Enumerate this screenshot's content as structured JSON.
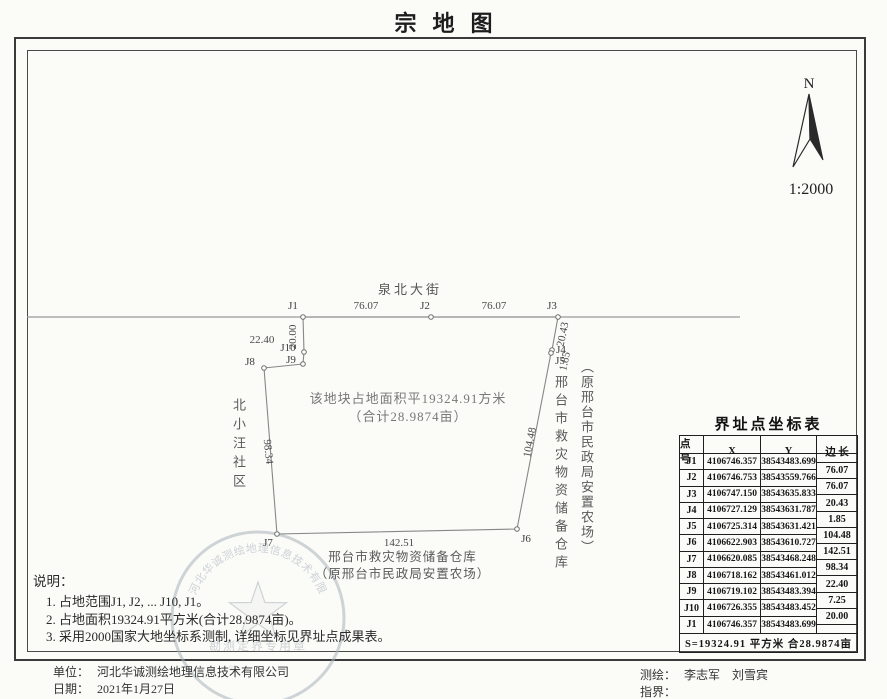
{
  "title": "宗地图",
  "north_arrow": {
    "n_label": "N",
    "scale": "1:2000"
  },
  "map": {
    "street_name": "泉北大街",
    "area_text_line1": "该地块占地面积平19324.91方米",
    "area_text_line2": "（合计28.9874亩）",
    "west_label": "北小汪社区",
    "east_label_1": "邢台市救灾物资储备仓库",
    "east_label_2": "（原邢台市民政局安置农场）",
    "south_label_1": "邢台市救灾物资储备仓库",
    "south_label_2": "（原邢台市民政局安置农场）",
    "street_line": {
      "x1": 27,
      "y1": 317,
      "x2": 740,
      "y2": 317
    },
    "points": [
      {
        "id": "J1",
        "px": 303,
        "py": 317,
        "lx": 293,
        "ly": 309
      },
      {
        "id": "J2",
        "px": 431,
        "py": 317,
        "lx": 425,
        "ly": 309
      },
      {
        "id": "J3",
        "px": 558,
        "py": 317,
        "lx": 552,
        "ly": 309
      },
      {
        "id": "J4",
        "px": 552,
        "py": 350,
        "lx": 561,
        "ly": 353
      },
      {
        "id": "J5",
        "px": 551,
        "py": 353,
        "lx": 560,
        "ly": 364
      },
      {
        "id": "J6",
        "px": 517,
        "py": 529,
        "lx": 526,
        "ly": 542
      },
      {
        "id": "J7",
        "px": 277,
        "py": 534,
        "lx": 268,
        "ly": 546
      },
      {
        "id": "J8",
        "px": 264,
        "py": 368,
        "lx": 250,
        "ly": 365
      },
      {
        "id": "J9",
        "px": 303,
        "py": 364,
        "lx": 291,
        "ly": 363
      },
      {
        "id": "J10",
        "px": 304,
        "py": 352,
        "lx": 288,
        "ly": 351
      }
    ],
    "edge_labels": [
      {
        "text": "76.07",
        "x": 366,
        "y": 309,
        "rot": 0
      },
      {
        "text": "76.07",
        "x": 494,
        "y": 309,
        "rot": 0
      },
      {
        "text": "20.43",
        "x": 566,
        "y": 335,
        "rot": -78
      },
      {
        "text": "1.85",
        "x": 568,
        "y": 362,
        "rot": -78
      },
      {
        "text": "104.48",
        "x": 533,
        "y": 443,
        "rot": -79
      },
      {
        "text": "142.51",
        "x": 399,
        "y": 546,
        "rot": 0
      },
      {
        "text": "98.34",
        "x": 265,
        "y": 452,
        "rot": 84
      },
      {
        "text": "22.40",
        "x": 262,
        "y": 343,
        "rot": 0
      },
      {
        "text": "20.00",
        "x": 296,
        "y": 337,
        "rot": -90
      }
    ]
  },
  "table": {
    "title": "界址点坐标表",
    "headers": [
      "点 号",
      "X",
      "Y",
      "边 长"
    ],
    "rows": [
      {
        "id": "J1",
        "x": "4106746.357",
        "y": "38543483.699"
      },
      {
        "id": "J2",
        "x": "4106746.753",
        "y": "38543559.766"
      },
      {
        "id": "J3",
        "x": "4106747.150",
        "y": "38543635.833"
      },
      {
        "id": "J4",
        "x": "4106727.129",
        "y": "38543631.787"
      },
      {
        "id": "J5",
        "x": "4106725.314",
        "y": "38543631.421"
      },
      {
        "id": "J6",
        "x": "4106622.903",
        "y": "38543610.727"
      },
      {
        "id": "J7",
        "x": "4106620.085",
        "y": "38543468.248"
      },
      {
        "id": "J8",
        "x": "4106718.162",
        "y": "38543461.012"
      },
      {
        "id": "J9",
        "x": "4106719.102",
        "y": "38543483.394"
      },
      {
        "id": "J10",
        "x": "4106726.355",
        "y": "38543483.452"
      },
      {
        "id": "J1",
        "x": "4106746.357",
        "y": "38543483.699"
      }
    ],
    "edge_lengths": [
      "76.07",
      "76.07",
      "20.43",
      "1.85",
      "104.48",
      "142.51",
      "98.34",
      "22.40",
      "7.25",
      "20.00"
    ],
    "footer": "S=19324.91 平方米 合28.9874亩"
  },
  "notes": {
    "title": "说明：",
    "items": [
      "1. 占地范围J1, J2, ... J10, J1。",
      "2. 占地面积19324.91平方米(合计28.9874亩)。",
      "3. 采用2000国家大地坐标系测制, 详细坐标见界址点成果表。"
    ]
  },
  "stamp": {
    "arc_text": "河北华诚测绘地理信息技术有限公司",
    "banner_text": "勘测定界专用章",
    "serial": "032"
  },
  "footer": {
    "unit_label": "单位：",
    "unit_value": "河北华诚测绘地理信息技术有限公司",
    "date_label": "日期：",
    "date_value": "2021年1月27日",
    "surveyor_label": "测绘：",
    "surveyor_value": "李志军　刘雪宾",
    "boundary_label": "指界：",
    "boundary_value": ""
  }
}
